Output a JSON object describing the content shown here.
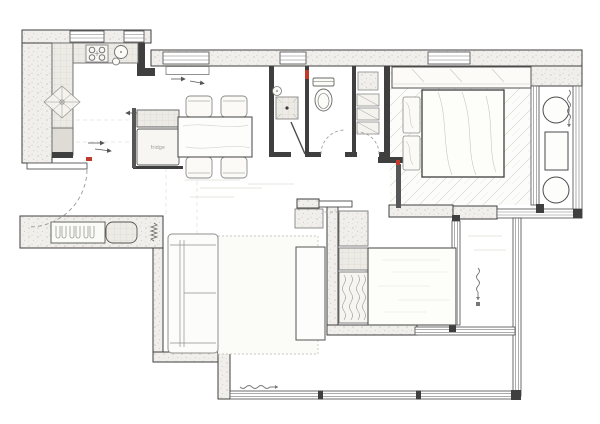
{
  "plan": {
    "type": "apartment-floor-plan",
    "labels": {
      "fridge": "fridge"
    },
    "colors": {
      "background": "#ffffff",
      "wall_line": "#3f3f3f",
      "wall_fill": "#f0efeb",
      "stipple_dot": "#b9b7b0",
      "tile_line": "#cfccc2",
      "furniture_line": "#8a8a8a",
      "floor_hatch": "#d9d7d0",
      "accent_red": "#c0392b",
      "label_text": "#9a978f"
    },
    "rooms": [
      {
        "name": "kitchen",
        "area": "top-left"
      },
      {
        "name": "dining",
        "area": "center-left"
      },
      {
        "name": "bathroom-shower",
        "area": "top-center"
      },
      {
        "name": "bathroom-wc",
        "area": "top-center"
      },
      {
        "name": "laundry-storage",
        "area": "top-center"
      },
      {
        "name": "master-bedroom",
        "area": "top-right"
      },
      {
        "name": "master-balcony",
        "area": "right"
      },
      {
        "name": "entry",
        "area": "bottom-left"
      },
      {
        "name": "living-room",
        "area": "center"
      },
      {
        "name": "second-bedroom",
        "area": "bottom-center"
      },
      {
        "name": "balcony",
        "area": "bottom-right"
      }
    ],
    "furniture_symbols": [
      "kitchen-counter",
      "cooktop",
      "kitchen-sink",
      "drainer-sink",
      "fridge",
      "dining-table",
      "dining-chair",
      "radiator",
      "shower-tray",
      "wash-basin",
      "toilet",
      "shelves",
      "wardrobe",
      "double-bed",
      "pillows",
      "sofa",
      "rug",
      "tv-cabinet",
      "shoe-cabinet",
      "curtain",
      "balcony-table",
      "balcony-stool"
    ]
  }
}
